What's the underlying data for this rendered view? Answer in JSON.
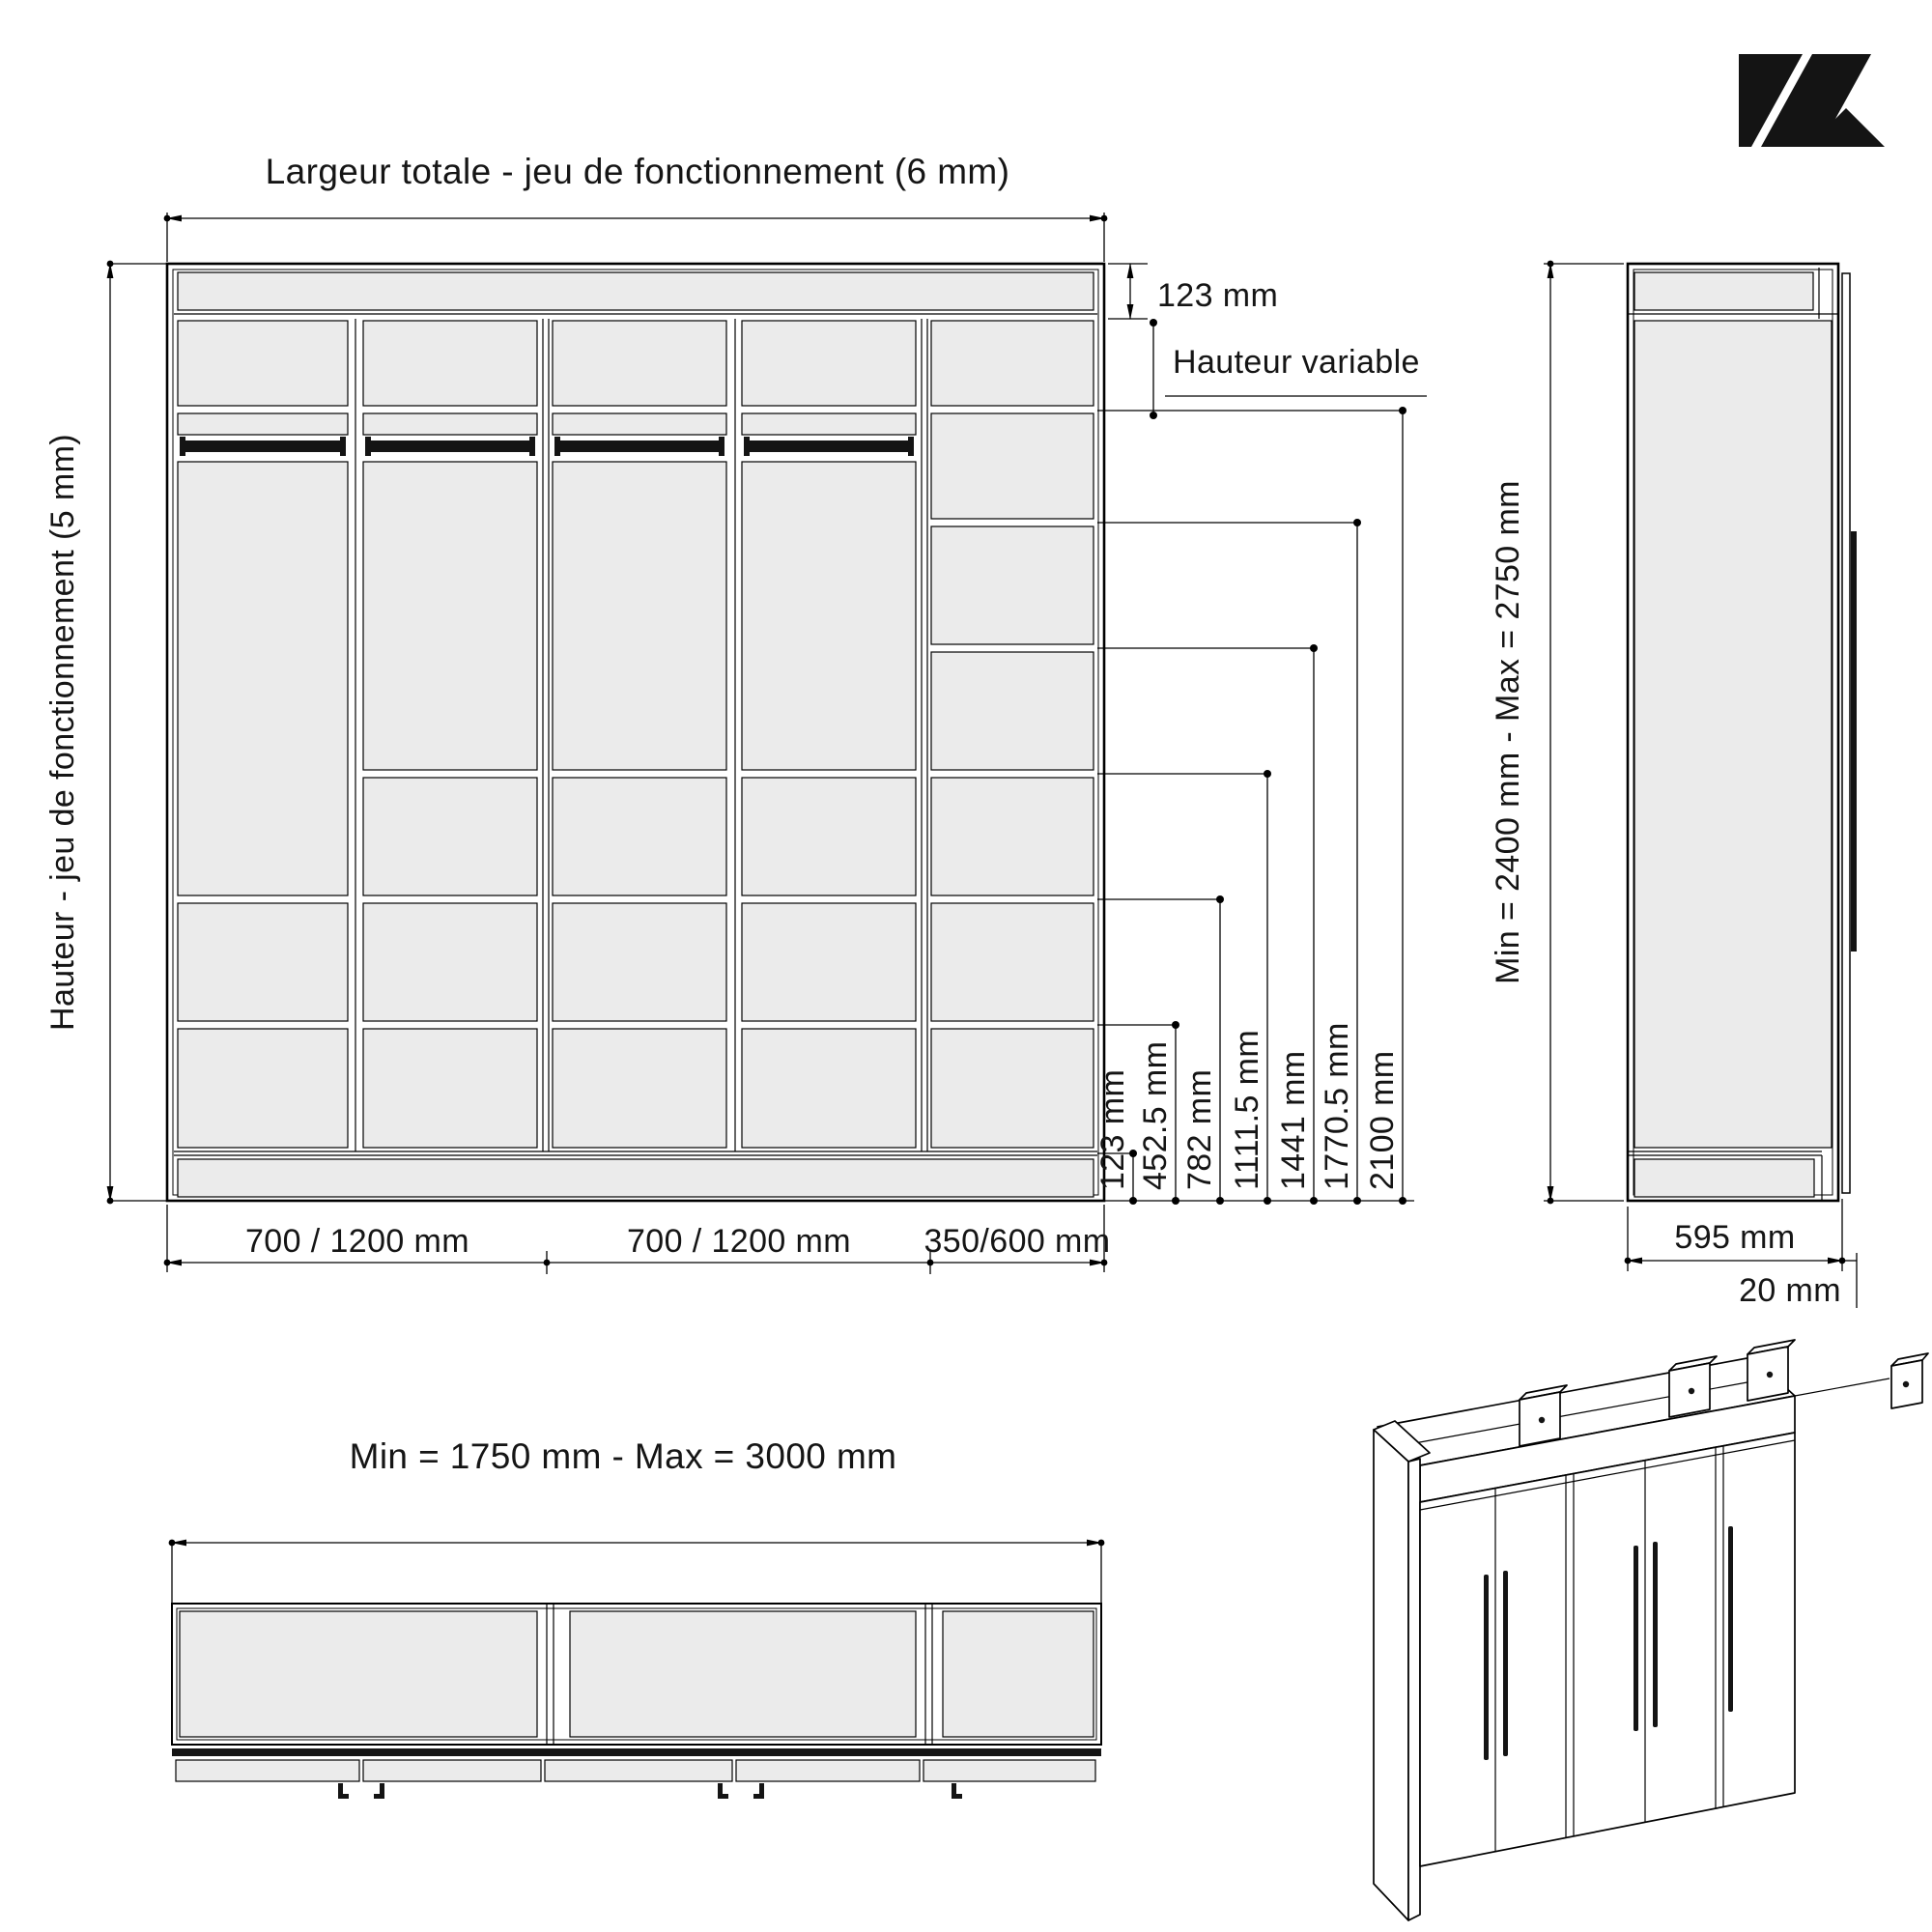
{
  "brand": {
    "logo": "K-mark"
  },
  "front_view": {
    "title": "Largeur totale - jeu de fonctionnement (6 mm)",
    "left_dim": "Hauteur - jeu de fonctionnement (5 mm)",
    "top_band_dim": "123 mm",
    "variable_dim": "Hauteur variable",
    "right_dims": [
      "123 mm",
      "452.5 mm",
      "782 mm",
      "1111.5 mm",
      "1441 mm",
      "1770.5 mm",
      "2100 mm"
    ],
    "bottom_dims": [
      "700 / 1200 mm",
      "700 / 1200 mm",
      "350/600 mm"
    ]
  },
  "side_view": {
    "height_dim": "Min = 2400 mm - Max = 2750 mm",
    "depth_dim": "595 mm",
    "thickness_dim": "20 mm"
  },
  "plan_view": {
    "width_dim": "Min = 1750 mm - Max = 3000 mm"
  },
  "colors": {
    "panel": "#ebebeb",
    "line": "#000000",
    "accent": "#141414"
  }
}
